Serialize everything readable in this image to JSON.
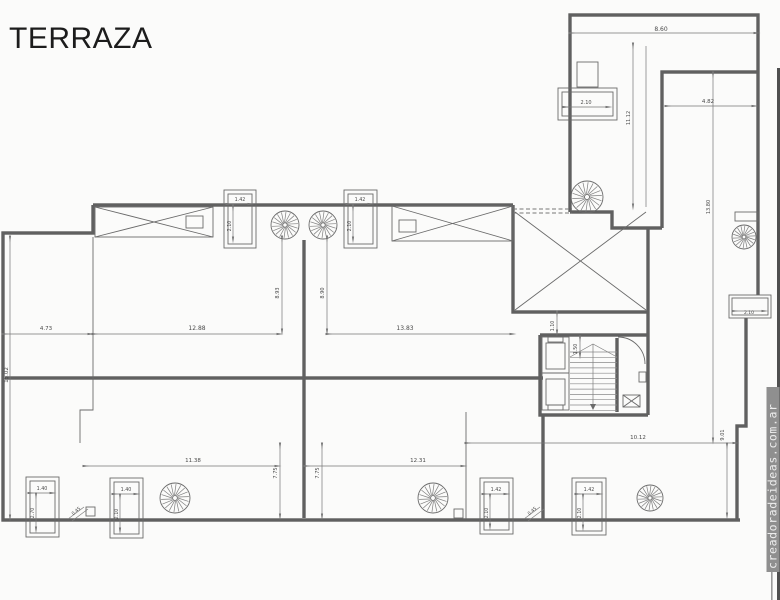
{
  "title": "TERRAZA",
  "watermark": "creadoradeideas.com.ar",
  "colors": {
    "wall_line": "#606060",
    "thin_line": "#6a6a6a",
    "dimension_line": "#767676",
    "label_text": "#4a4a4a",
    "watermark_bar": "#8f8f8f",
    "watermark_text": "#ececec",
    "edge_strip": "#4f4f4f",
    "background": "#fbfbfa"
  },
  "plan": {
    "dimension_labels": [
      {
        "id": "d860",
        "value": "8.60"
      },
      {
        "id": "d482",
        "value": "4.82"
      },
      {
        "id": "d1112",
        "value": "11.12"
      },
      {
        "id": "d1380",
        "value": "13.80"
      },
      {
        "id": "dpt210",
        "value": "2.10"
      },
      {
        "id": "dcaW",
        "value": "1.42"
      },
      {
        "id": "dcaH",
        "value": "2.10"
      },
      {
        "id": "dcbW",
        "value": "1.42"
      },
      {
        "id": "dcbH",
        "value": "2.10"
      },
      {
        "id": "d893",
        "value": "8.93"
      },
      {
        "id": "d890",
        "value": "8.90"
      },
      {
        "id": "d473",
        "value": "4.73"
      },
      {
        "id": "d1288",
        "value": "12.88"
      },
      {
        "id": "d1383",
        "value": "13.83"
      },
      {
        "id": "d1502",
        "value": "15.02"
      },
      {
        "id": "d110",
        "value": "1.10"
      },
      {
        "id": "d150",
        "value": "1.50"
      },
      {
        "id": "d1138",
        "value": "11.38"
      },
      {
        "id": "d1231",
        "value": "12.31"
      },
      {
        "id": "d1012",
        "value": "10.12"
      },
      {
        "id": "d775a",
        "value": "7.75"
      },
      {
        "id": "d775b",
        "value": "7.75"
      },
      {
        "id": "d901",
        "value": "9.01"
      },
      {
        "id": "d045a",
        "value": "0.45"
      },
      {
        "id": "d045b",
        "value": "0.45"
      },
      {
        "id": "dpr210",
        "value": "2.10"
      },
      {
        "id": "dc1W",
        "value": "1.40"
      },
      {
        "id": "dc1H",
        "value": "2.70"
      },
      {
        "id": "dc2W",
        "value": "1.40"
      },
      {
        "id": "dc2H",
        "value": "2.10"
      },
      {
        "id": "dc3W",
        "value": "1.42"
      },
      {
        "id": "dc3H",
        "value": "2.10"
      },
      {
        "id": "dc4W",
        "value": "1.42"
      },
      {
        "id": "dc4H",
        "value": "2.10"
      }
    ]
  }
}
